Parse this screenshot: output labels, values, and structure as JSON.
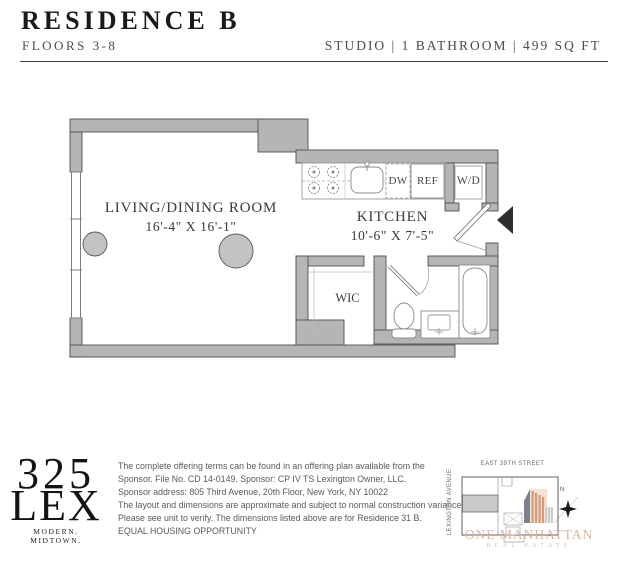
{
  "header": {
    "title": "RESIDENCE B",
    "subtitle": "FLOORS 3-8",
    "specs": "STUDIO | 1 BATHROOM | 499 SQ FT"
  },
  "floorplan": {
    "living_name": "LIVING/DINING ROOM",
    "living_dims": "16'-4\" X 16'-1\"",
    "kitchen_name": "KITCHEN",
    "kitchen_dims": "10'-6\" X 7'-5\"",
    "wic_label": "WIC",
    "dishwasher_label": "DW",
    "refrigerator_label": "REF",
    "washer_dryer_label": "W/D"
  },
  "footer": {
    "logo_number": "325",
    "logo_name": "LEX",
    "logo_tagline": "MODERN. MIDTOWN.",
    "disclaimer_lines": [
      "The complete offering terms can be found in an offering plan available from the",
      "Sponsor. File No. CD 14-0149. Sponsor: CP IV TS Lexington Owner, LLC.",
      "Sponsor address: 805 Third Avenue, 20th Floor, New York, NY 10022",
      "The layout and dimensions are approximate and subject to normal construction variances.",
      "Please see unit to verify. The dimensions listed above are for Residence 31 B.",
      "EQUAL HOUSING OPPORTUNITY"
    ],
    "keyplan": {
      "street_label": "EAST 39TH STREET",
      "avenue_label": "LEXINGTON AVENUE",
      "north_label": "N",
      "watermark_line1": "ONE MANHATTAN",
      "watermark_line2": "REAL ESTATE"
    }
  },
  "colors": {
    "wall_fill": "#b5b5b5",
    "wall_stroke": "#4f4f4f",
    "fixture_stroke": "#8a8a8a",
    "text_dark": "#1a1a1a",
    "text_gray": "#4b4b4b",
    "watermark_tan": "#d8b096",
    "keyplan_orange": "#d59a74"
  }
}
